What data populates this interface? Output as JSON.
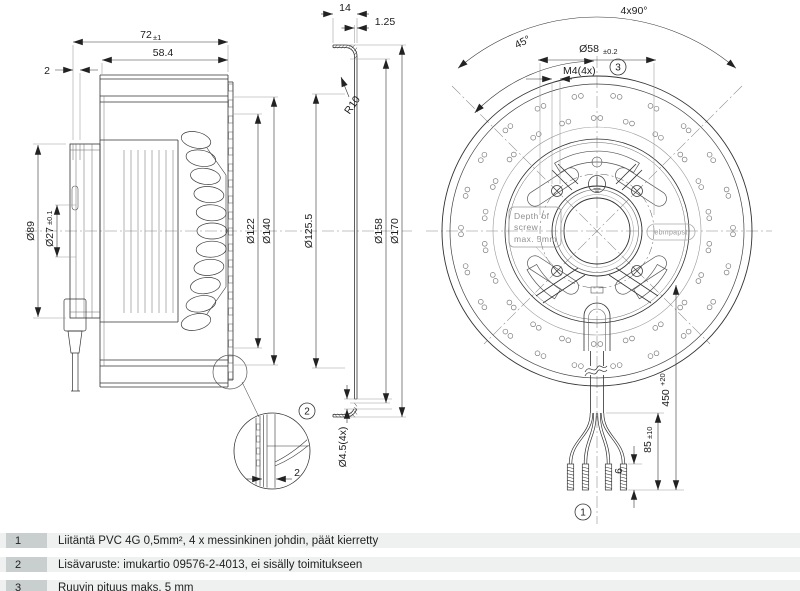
{
  "drawing": {
    "side_view": {
      "dim_width": "72",
      "dim_width_tol": "±1",
      "dim_inner_width": "58.4",
      "dim_lip": "2",
      "dim_d89": "Ø89",
      "dim_d27": "Ø27",
      "dim_d27_tol": "±0.1",
      "dim_d122": "Ø122",
      "dim_d140": "Ø140"
    },
    "section_view": {
      "dim_depth": "14",
      "dim_thickness": "1.25",
      "dim_radius": "R10",
      "dim_d125_5": "Ø125.5",
      "dim_d158": "Ø158",
      "dim_d170": "Ø170",
      "dim_hole": "Ø4.5(4x)"
    },
    "front_view": {
      "dim_angle_pattern": "4x90°",
      "dim_angle": "45°",
      "dim_bolt_circle": "Ø58",
      "dim_bolt_circle_tol": "±0.2",
      "dim_thread": "M4(4x)",
      "dim_cable_length": "450",
      "dim_cable_length_tol": "+20",
      "dim_strip_length": "85",
      "dim_strip_length_tol": "±10",
      "dim_tinned_length": "6",
      "screw_note_line1": "Depth of",
      "screw_note_line2": "screw",
      "screw_note_line3": "max. 5mm",
      "logo_text": "ebmpapst"
    },
    "detail_view": {
      "dim_gap": "2"
    },
    "callouts": {
      "note1": "1",
      "note2": "2",
      "note3": "3"
    }
  },
  "notes": {
    "rows": [
      {
        "num": "1",
        "text": "Liitäntä PVC 4G 0,5mm², 4 x messinkinen johdin, päät kierretty"
      },
      {
        "num": "2",
        "text": "Lisävaruste: imukartio 09576-2-4013, ei sisälly toimitukseen"
      },
      {
        "num": "3",
        "text": "Ruuvin pituus maks. 5 mm"
      }
    ]
  }
}
